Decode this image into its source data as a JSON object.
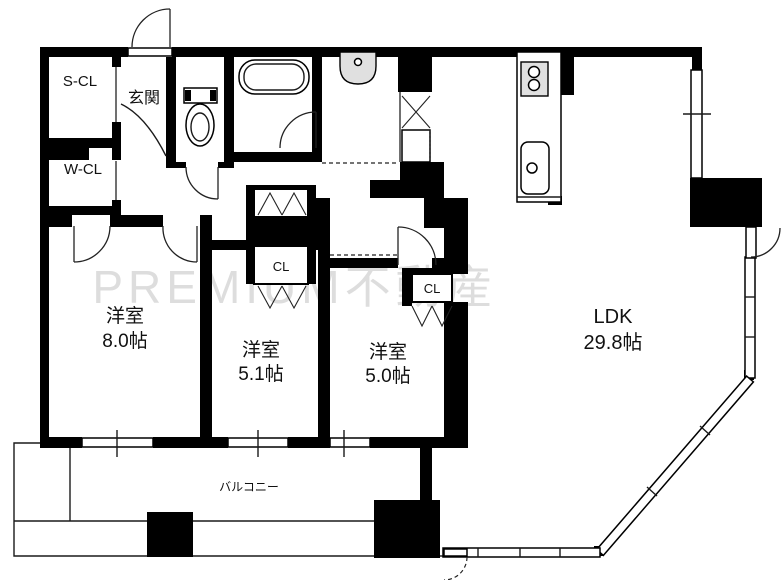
{
  "watermark": "PREMIUM不動産",
  "colors": {
    "wall": "#000000",
    "line": "#1a1a1a",
    "watermark": "#c9c9c9",
    "fixture_fill": "#e0e0e0",
    "background": "#ffffff"
  },
  "rooms": {
    "ldk": {
      "name": "LDK",
      "size": "29.8帖"
    },
    "bedroom_8": {
      "name": "洋室",
      "size": "8.0帖"
    },
    "bedroom_51": {
      "name": "洋室",
      "size": "5.1帖"
    },
    "bedroom_50": {
      "name": "洋室",
      "size": "5.0帖"
    },
    "entrance": {
      "name": "玄関"
    },
    "shoes_closet": {
      "name": "S-CL"
    },
    "walkin_closet": {
      "name": "W-CL"
    },
    "closet_51": {
      "name": "CL"
    },
    "closet_50": {
      "name": "CL"
    },
    "balcony": {
      "name": "バルコニー"
    }
  }
}
